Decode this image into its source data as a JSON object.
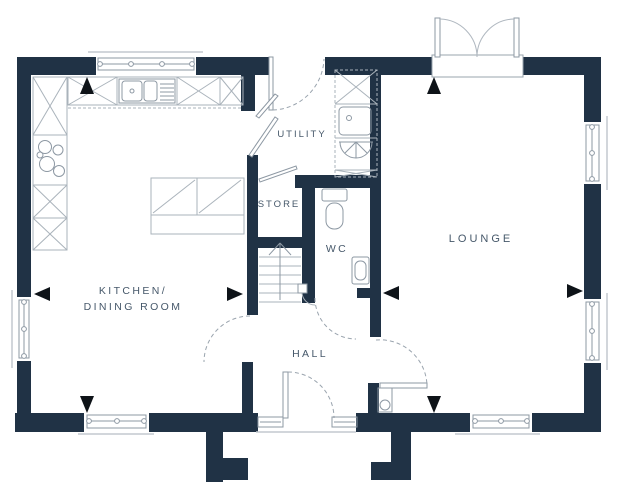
{
  "labels": {
    "kitchen_line1": "KITCHEN/",
    "kitchen_line2": "DINING ROOM",
    "utility": "UTILITY",
    "store": "STORE",
    "wc": "WC",
    "hall": "HALL",
    "lounge": "LOUNGE"
  },
  "colors": {
    "wall": "#203245",
    "label_text": "#46586a",
    "cabinet_line": "#aab3bb",
    "fixture_line": "#8d98a3",
    "door_arc": "#9aa4ae",
    "measure_marker": "#0e1318",
    "background": "#ffffff"
  },
  "fixtures": {
    "kitchen": [
      "worktop-cabinets",
      "sink-with-drainer",
      "hob",
      "island-unit"
    ],
    "utility": [
      "cabinets",
      "sink",
      "washing-machine"
    ],
    "wc": [
      "toilet",
      "basin"
    ],
    "hall": [
      "staircase",
      "cylinder-cupboard"
    ],
    "lounge": []
  },
  "openings": [
    "kitchen-window-rear",
    "kitchen-window-side",
    "kitchen-window-front",
    "lounge-french-doors",
    "lounge-window-side-upper",
    "lounge-window-side-lower",
    "lounge-window-front",
    "back-door",
    "front-door-with-sidelights"
  ],
  "markers": [
    "kitchen-measure-arrows",
    "lounge-measure-arrows"
  ]
}
